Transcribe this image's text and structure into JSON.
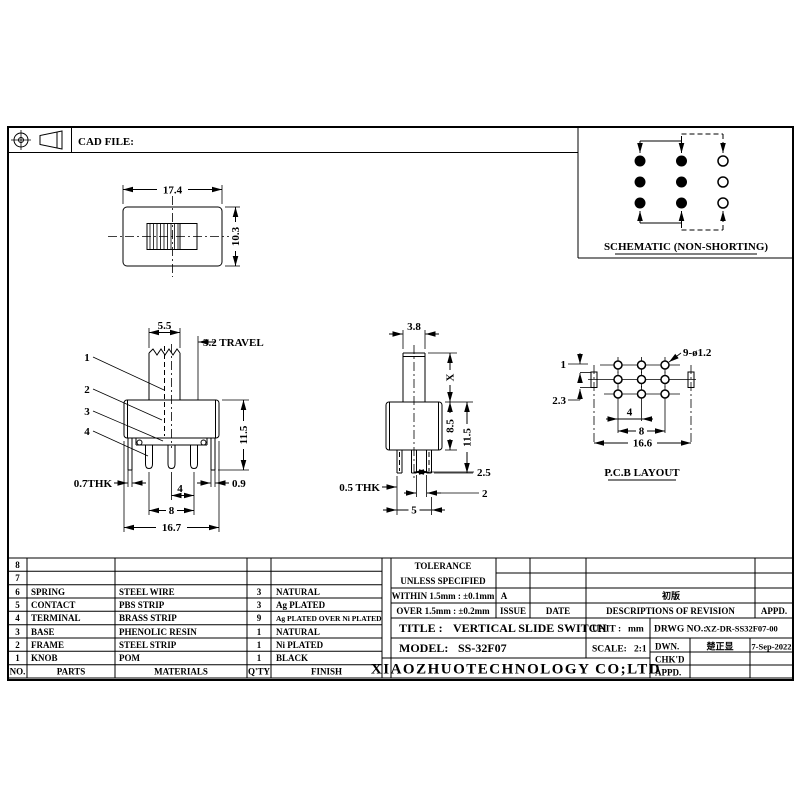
{
  "drawing": {
    "cad_file_label": "CAD FILE:",
    "schematic": {
      "title": "SCHEMATIC (NON-SHORTING)"
    },
    "top_view": {
      "width": "17.4",
      "height": "10.3"
    },
    "front_view": {
      "knob_width": "5.5",
      "travel": "3.2 TRAVEL",
      "callout_1": "1",
      "callout_2": "2",
      "callout_3": "3",
      "callout_4": "4",
      "height": "11.5",
      "thk": "0.7THK",
      "end_gap": "0.9",
      "pitch": "4",
      "span": "8",
      "total_width": "16.7"
    },
    "side_view": {
      "knob_width": "3.8",
      "knob_height": "X",
      "body_height": "8.5",
      "height": "11.5",
      "leg_offset": "2.5",
      "leg_gap": "2",
      "leg_span": "5",
      "thk": "0.5 THK"
    },
    "pcb": {
      "title": "P.C.B LAYOUT",
      "holes": "9-ø1.2",
      "dim_top": "1",
      "dim_side": "2.3",
      "pitch": "4",
      "span": "8",
      "total": "16.6"
    }
  },
  "parts_table": {
    "headers": {
      "no": "NO.",
      "parts": "PARTS",
      "materials": "MATERIALS",
      "qty": "Q'TY",
      "finish": "FINISH"
    },
    "rows": [
      {
        "no": "8",
        "part": "",
        "material": "",
        "qty": "",
        "finish": ""
      },
      {
        "no": "7",
        "part": "",
        "material": "",
        "qty": "",
        "finish": ""
      },
      {
        "no": "6",
        "part": "SPRING",
        "material": "STEEL WIRE",
        "qty": "3",
        "finish": "NATURAL"
      },
      {
        "no": "5",
        "part": "CONTACT",
        "material": "PBS STRIP",
        "qty": "3",
        "finish": "Ag PLATED"
      },
      {
        "no": "4",
        "part": "TERMINAL",
        "material": "BRASS STRIP",
        "qty": "9",
        "finish": "Ag PLATED OVER Ni PLATED"
      },
      {
        "no": "3",
        "part": "BASE",
        "material": "PHENOLIC RESIN",
        "qty": "1",
        "finish": "NATURAL"
      },
      {
        "no": "2",
        "part": "FRAME",
        "material": "STEEL STRIP",
        "qty": "1",
        "finish": "Ni PLATED"
      },
      {
        "no": "1",
        "part": "KNOB",
        "material": "POM",
        "qty": "1",
        "finish": "BLACK"
      }
    ]
  },
  "title_block": {
    "tolerance_line1": "TOLERANCE",
    "tolerance_line2": "UNLESS  SPECIFIED",
    "tol_within": "WITHIN 1.5mm : ±0.1mm",
    "tol_over": "OVER 1.5mm : ±0.2mm",
    "issue_value": "A",
    "revision_desc": "初版",
    "issue_label": "ISSUE",
    "date_label": "DATE",
    "desc_label": "DESCRIPTIONS OF REVISION",
    "appd_label": "APPD.",
    "title_label": "TITLE :",
    "title_value": "VERTICAL SLIDE SWITCH",
    "unit_label": "UNIT :",
    "unit_value": "mm",
    "drwg_label": "DRWG NO.:",
    "drwg_value": "XZ-DR-SS32F07-00",
    "model_label": "MODEL:",
    "model_value": "SS-32F07",
    "scale_label": "SCALE:",
    "scale_value": "2:1",
    "dwn_label": "DWN.",
    "dwn_name": "楚正显",
    "dwn_date": "7-Sep-2022",
    "chkd_label": "CHK'D",
    "appd_row_label": "APPD.",
    "company": "XIAOZHUOTECHNOLOGY  CO;LTD"
  },
  "colors": {
    "line": "#000000",
    "background": "#ffffff"
  }
}
